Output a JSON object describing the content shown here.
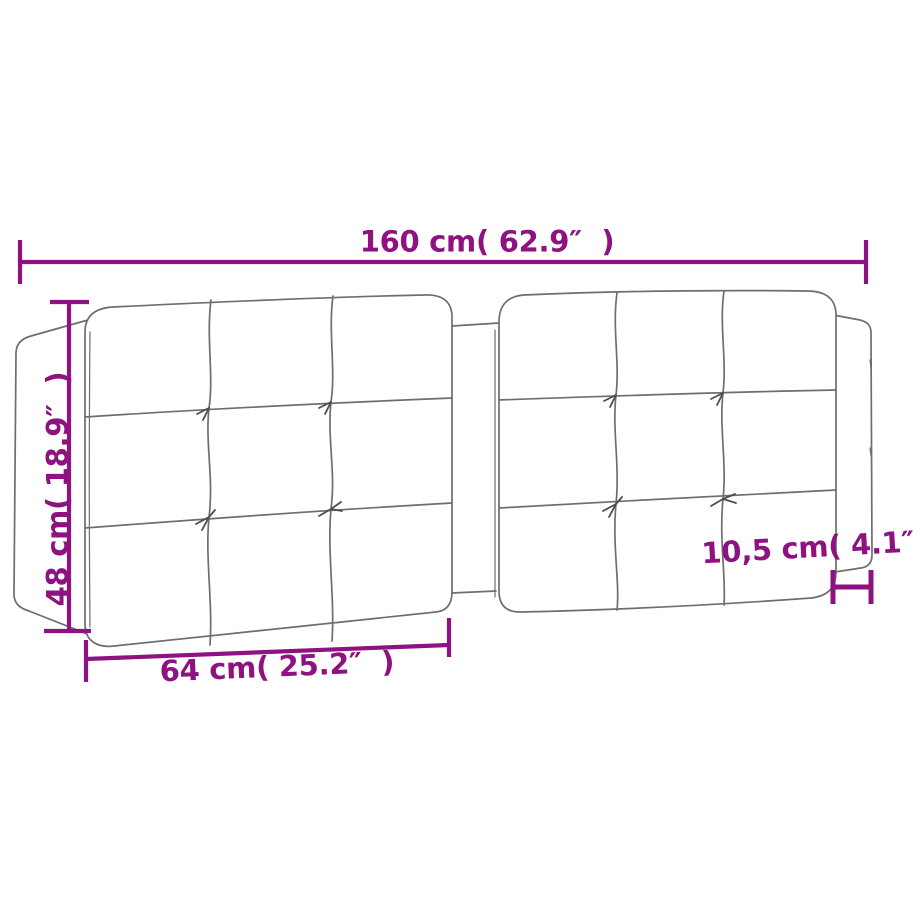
{
  "colors": {
    "accent": "#8E1280",
    "drawing": "#6E6E6E"
  },
  "dimensions": {
    "total_width": {
      "label": "160 cm( 62.9″  )"
    },
    "height": {
      "label": "48 cm( 18.9″  )"
    },
    "panel_width": {
      "label": "64 cm( 25.2″  )"
    },
    "side_depth": {
      "label": "10,5 cm( 4.1″  )"
    }
  }
}
